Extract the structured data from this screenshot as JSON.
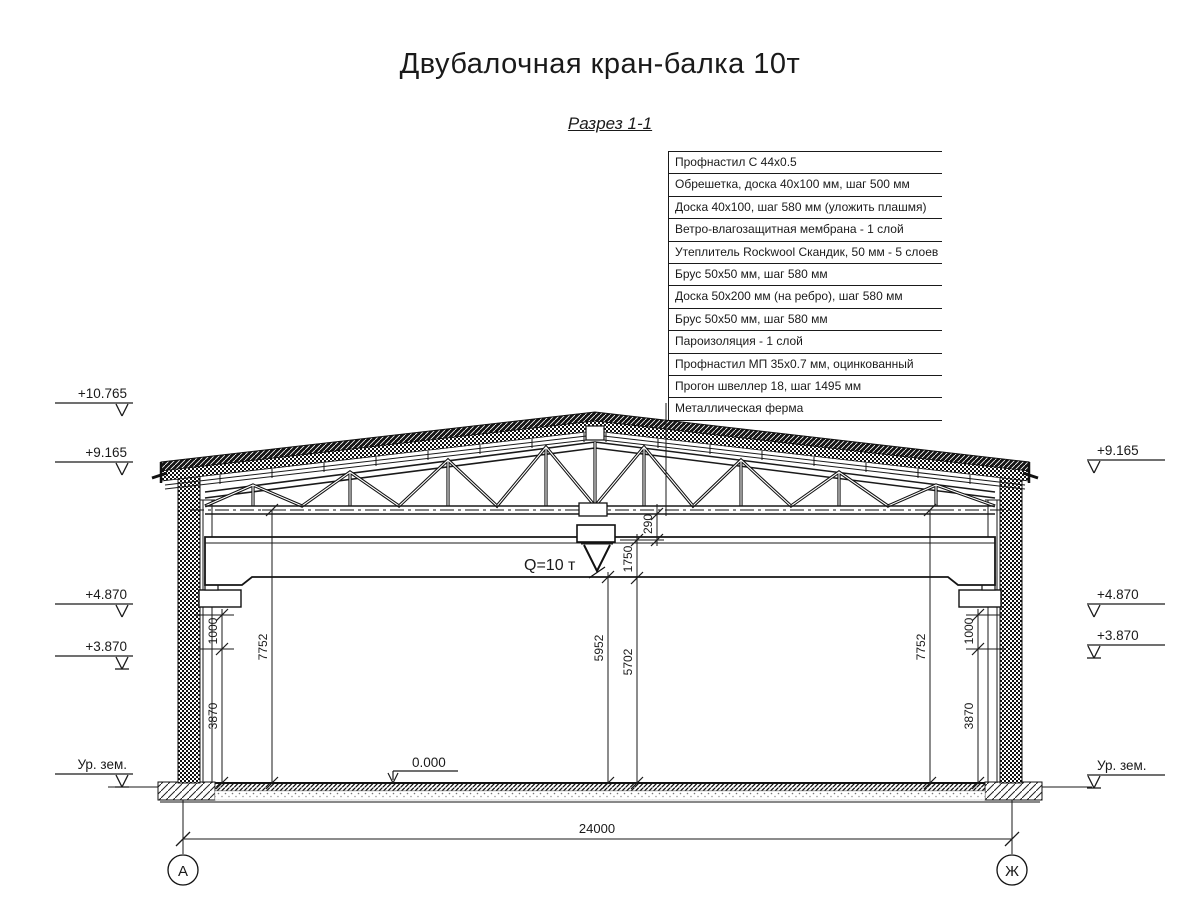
{
  "title": "Двубалочная кран-балка 10т",
  "view_label": "Разрез 1-1",
  "callout_table": {
    "rows": [
      "Профнастил С 44х0.5",
      "Обрешетка, доска 40х100 мм, шаг 500 мм",
      "Доска 40х100, шаг 580 мм (уложить плашмя)",
      "Ветро-влагозащитная мембрана - 1 слой",
      "Утеплитель Rockwool Скандик, 50 мм - 5 слоев",
      "Брус 50х50 мм, шаг 580 мм",
      "Доска 50х200 мм (на ребро), шаг 580 мм",
      "Брус 50х50 мм, шаг 580 мм",
      "Пароизоляция - 1 слой",
      "Профнастил МП 35х0.7 мм, оцинкованный",
      "Прогон швеллер 18, шаг 1495 мм",
      "Металлическая ферма"
    ]
  },
  "elevation_marks": {
    "ridge": "+10.765",
    "eave": "+9.165",
    "corbel": "+4.870",
    "rail": "+3.870",
    "ground": "Ур. зем.",
    "floor_zero": "0.000"
  },
  "dims": {
    "span": "24000",
    "wall_clear_height": "7752",
    "corbel_step": "1000",
    "corbel_height": "3870",
    "hook_clearance": "5952",
    "under_hook": "5702",
    "beam_zone": "1750",
    "chord_gap": "290"
  },
  "crane": {
    "capacity_label": "Q=10 т"
  },
  "grid_axes": {
    "left": "А",
    "right": "Ж"
  },
  "colors": {
    "ink": "#1a1a1a",
    "paper": "#ffffff",
    "slab_grey": "#888888"
  }
}
